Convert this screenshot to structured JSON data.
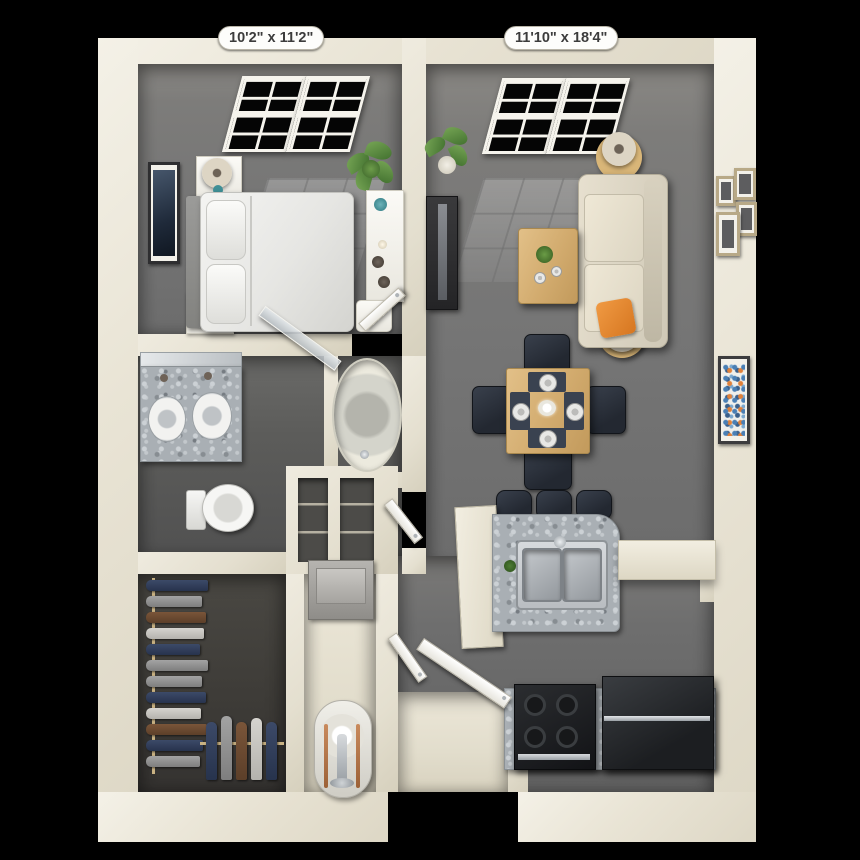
{
  "app": {
    "type": "3d-rendered-apartment-floor-plan",
    "view": "top-down dollhouse render on black background"
  },
  "labels": {
    "bedroom_dimensions": "10'2\" x 11'2\"",
    "living_room_dimensions": "11'10\" x 18'4\""
  },
  "palette": {
    "background": "#000000",
    "wall_cream": "#e9e4d5",
    "carpet_gray": "#757575",
    "bathroom_floor": "#5c5c5a",
    "closet_floor": "#3d3b37",
    "granite_counter": "#a9afb4",
    "light_wood": "#d2ab6e",
    "sofa_cream": "#e3dccb",
    "accent_orange": "#e2822e",
    "lamp_teal": "#3f8f96",
    "chair_navy": "#232831",
    "appliance_black": "#17181a",
    "copper_pipe": "#b5764a",
    "plant_green": "#4f7d35"
  },
  "rooms": [
    {
      "name": "bedroom",
      "position": "top-left",
      "furniture": [
        "double window",
        "bed with white duvet and pillows",
        "gray headboard",
        "two nightstands with teal lamps",
        "framed wall art",
        "potted plant",
        "white console with vases and candle",
        "white stool",
        "open door"
      ]
    },
    {
      "name": "living-room",
      "position": "top-right",
      "furniture": [
        "double window",
        "cream sofa with two orange pillows",
        "two round wood end tables with lamps",
        "wood coffee table with plant and dishes",
        "tv on dark media stand",
        "potted plant",
        "gallery of four frames",
        "large framed abstract art"
      ]
    },
    {
      "name": "dining-area",
      "position": "center-right",
      "furniture": [
        "square wood table",
        "four navy chairs",
        "four place settings with plates and placemats",
        "white flower centerpiece"
      ]
    },
    {
      "name": "kitchen",
      "position": "right-bottom",
      "furniture": [
        "granite peninsula with double stainless sink",
        "three navy bar stools",
        "cream breakfast-bar shelf",
        "granite base counter",
        "black four-burner range",
        "black refrigerator"
      ]
    },
    {
      "name": "bathroom",
      "position": "middle-left",
      "furniture": [
        "granite double-sink vanity with mirror",
        "toilet",
        "glass shower door ajar",
        "oval garden tub in nook"
      ]
    },
    {
      "name": "walk-in-closet",
      "position": "bottom-left",
      "furniture": [
        "hanging clothes in navy gray brown and white",
        "wood clothes rods"
      ]
    },
    {
      "name": "utility-closet",
      "position": "bottom-center",
      "furniture": [
        "stacked laundry unit",
        "water heater with copper pipes",
        "linen niches with shelves"
      ]
    },
    {
      "name": "entry",
      "position": "bottom-center",
      "furniture": [
        "front door ajar",
        "recessed entry porch"
      ]
    }
  ]
}
